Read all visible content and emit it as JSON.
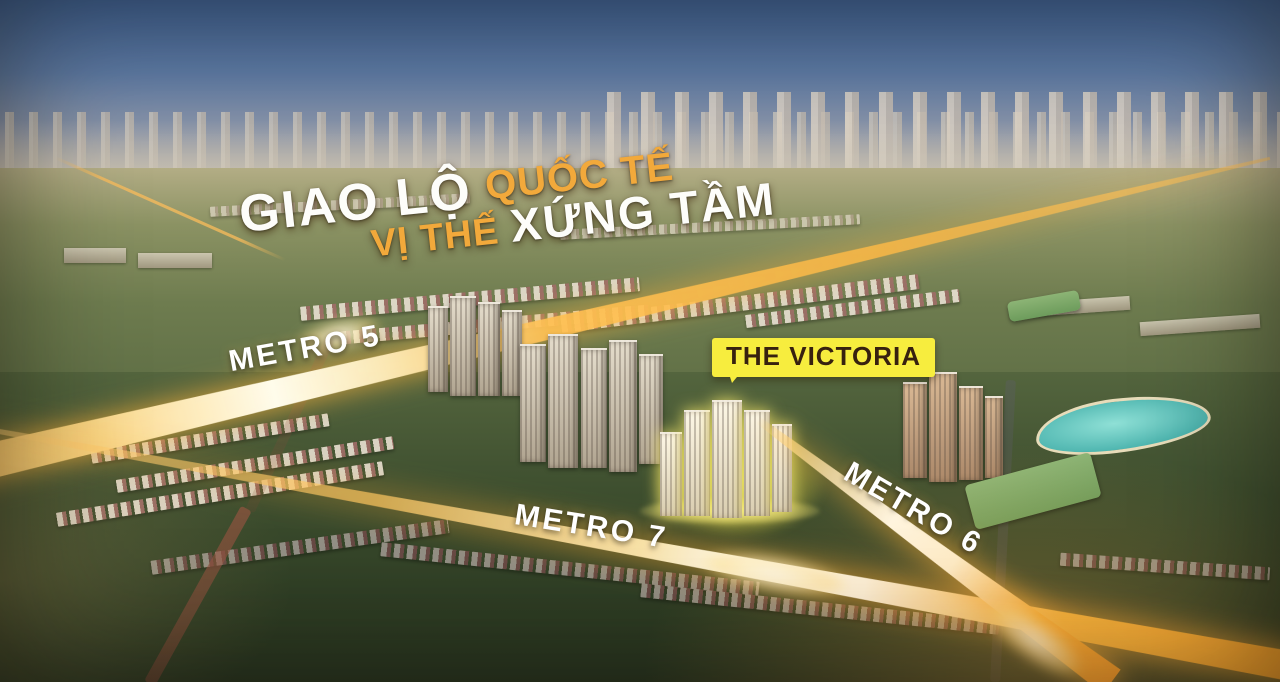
{
  "headline": {
    "giao_lo": "GIAO LỘ",
    "quoc_te": "QUỐC TẾ",
    "vi_the": "VỊ THẾ",
    "xung_tam": "XỨNG TẦM"
  },
  "metro_lines": {
    "metro5": {
      "label": "METRO 5"
    },
    "metro7": {
      "label": "METRO 7"
    },
    "metro6": {
      "label": "METRO 6"
    }
  },
  "victoria": {
    "label": "THE VICTORIA"
  },
  "colors": {
    "headline_white": "#fdfdfa",
    "headline_gold": "#f2a93b",
    "beam_gold": "#ffb840",
    "victoria_badge_bg": "#f7ed3e",
    "victoria_badge_text": "#37210f",
    "sky_blue_top": "#3f6397",
    "sunset_orange": "#f8c07c",
    "foliage_dark": "#2e3d24",
    "lagoon_teal": "#4fb6b0"
  }
}
